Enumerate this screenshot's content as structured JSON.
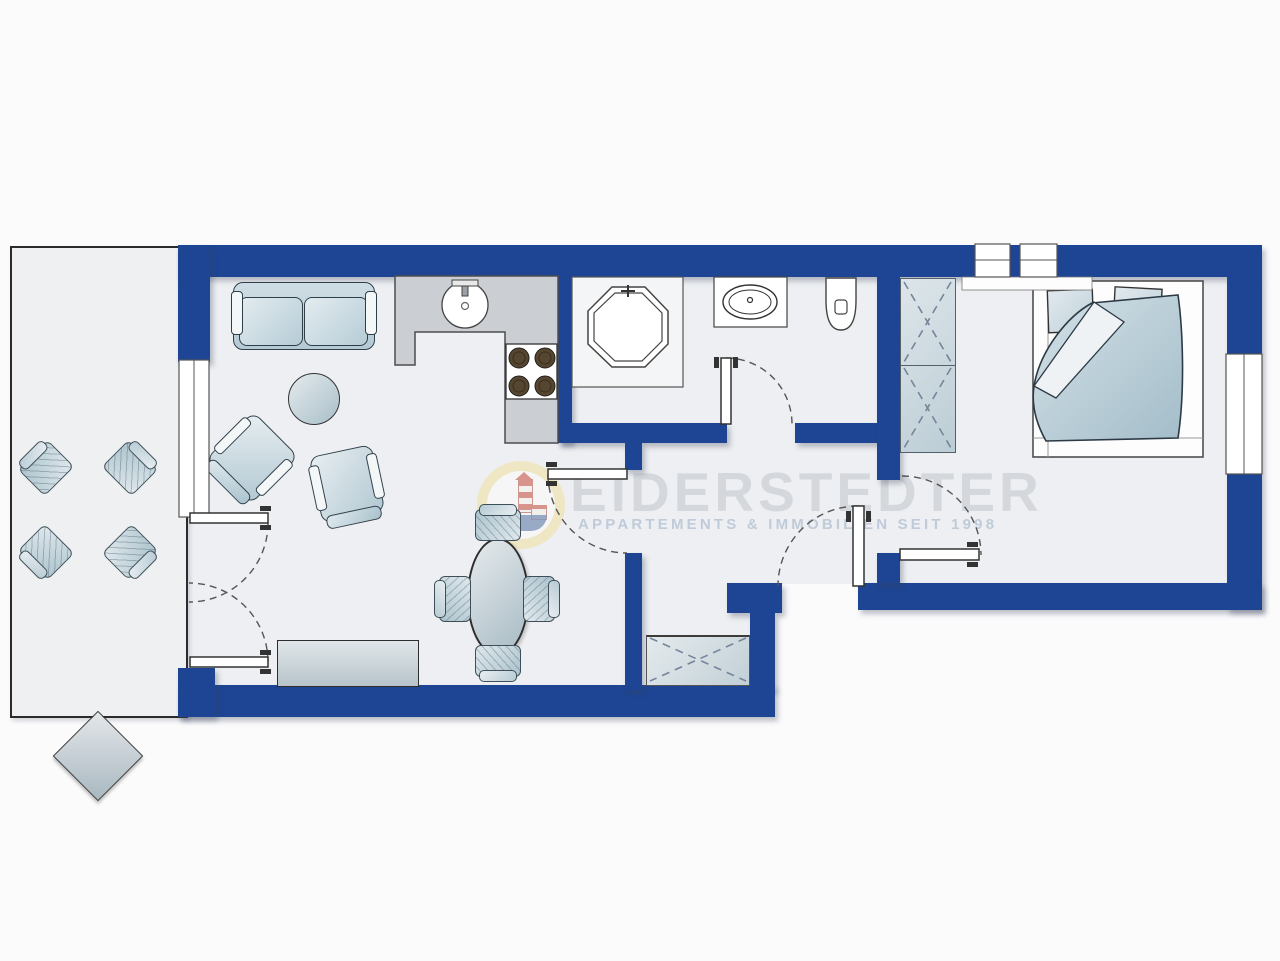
{
  "watermark": {
    "title": "EIDERSTEDTER",
    "subtitle": "APPARTEMENTS & IMMOBILIEN SEIT 1998"
  },
  "floorplan": {
    "type": "apartment floor plan, top-down view",
    "rooms": [
      {
        "name": "terrace",
        "items": [
          "square table rotated 45 degrees",
          "4 garden chairs"
        ]
      },
      {
        "name": "living-dining room",
        "items": [
          "two-seat sofa",
          "round coffee table",
          "2 armchairs",
          "oval dining table",
          "4 dining chairs",
          "sideboard"
        ]
      },
      {
        "name": "kitchen",
        "items": [
          "L-shaped counter",
          "round sink with faucet",
          "stove with 4 burners"
        ]
      },
      {
        "name": "bathroom",
        "items": [
          "octagonal corner shower",
          "washbasin vanity",
          "toilet"
        ]
      },
      {
        "name": "hallway",
        "items": [
          "built-in wardrobe with X mark"
        ]
      },
      {
        "name": "bedroom",
        "items": [
          "double bed with duvet",
          "2 pillows",
          "wardrobe with X marks"
        ]
      }
    ],
    "doors": [
      "terrace double door with swing arcs",
      "living room to hall door",
      "bathroom door",
      "bedroom door",
      "entrance door"
    ],
    "windows": [
      "living room window to terrace",
      "two bedroom top windows",
      "bedroom right-side window"
    ]
  },
  "colors": {
    "wall": "#1e4593",
    "floor": "#edeff2",
    "kitchen_counter": "#cbcfd3",
    "furniture_accent": "#b5cad4",
    "watermark_text": "#c6cbcf",
    "logo_ring_yellow": "#f1df9f",
    "logo_red": "#c74a3a"
  }
}
